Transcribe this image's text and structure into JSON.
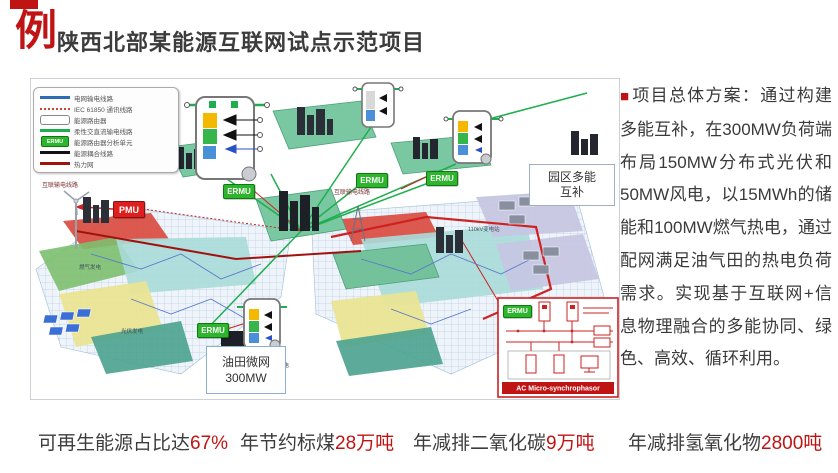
{
  "header": {
    "badge_mark": "例",
    "title": "陕西北部某能源互联网试点示范项目"
  },
  "right_panel": {
    "bullet": "■",
    "text": "项目总体方案：通过构建多能互补，在300MW负荷端布局150MW分布式光伏和50MW风电，以15MWh的储能和100MW燃气热电，通过配网满足油气田的热电负荷需求。实现基于互联网+信息物理融合的多能协同、绿色、高效、循环利用。"
  },
  "stats": {
    "items": [
      {
        "prefix": "可再生能源占比达",
        "value": "67%"
      },
      {
        "prefix": "年节约标煤",
        "value": "28万吨"
      },
      {
        "prefix": "年减排二氧化碳",
        "value": "9万吨"
      },
      {
        "prefix": "年减排氢氧化物",
        "value": "2800吨"
      }
    ]
  },
  "diagram": {
    "badges": {
      "pmu": "PMU",
      "ermu": "ERMU"
    },
    "legend": {
      "items": [
        {
          "label": "电网输电线路",
          "swatch": "blue-line"
        },
        {
          "label": "IEC 61850 通讯线路",
          "swatch": "red-dotted-line"
        },
        {
          "label": "能源路由器",
          "swatch": "white-box"
        },
        {
          "label": "柔性交直流输电线路",
          "swatch": "green-line"
        },
        {
          "label": "能源路由器分析单元",
          "swatch": "ermu-badge"
        },
        {
          "label": "能源耦合线路",
          "swatch": "black-line"
        },
        {
          "label": "热力网",
          "swatch": "dark-red-line"
        }
      ]
    },
    "labels": {
      "interconnect_line": "互联输电线路",
      "park_line1": "园区多能",
      "park_line2": "互补",
      "oilfield_line1": "油田微网",
      "oilfield_line2": "300MW",
      "ac_micro": "AC Micro-synchrophasor"
    },
    "small_labels": [
      "110kV变电站",
      "燃气发电",
      "光伏发电",
      "火力发电"
    ],
    "colors": {
      "accent_red": "#c01414",
      "ermu_green": "#2db52d",
      "pmu_red": "#dd1f1f",
      "line_green": "#1fae4e",
      "line_blue": "#2e6db4",
      "heat_red": "#a01212",
      "platform_green": "#79c8a2",
      "zone_red": "#d94b40",
      "zone_cyan": "#a8dbd8",
      "zone_yellow": "#e9e493",
      "zone_lavender": "#c6c6e2"
    }
  }
}
